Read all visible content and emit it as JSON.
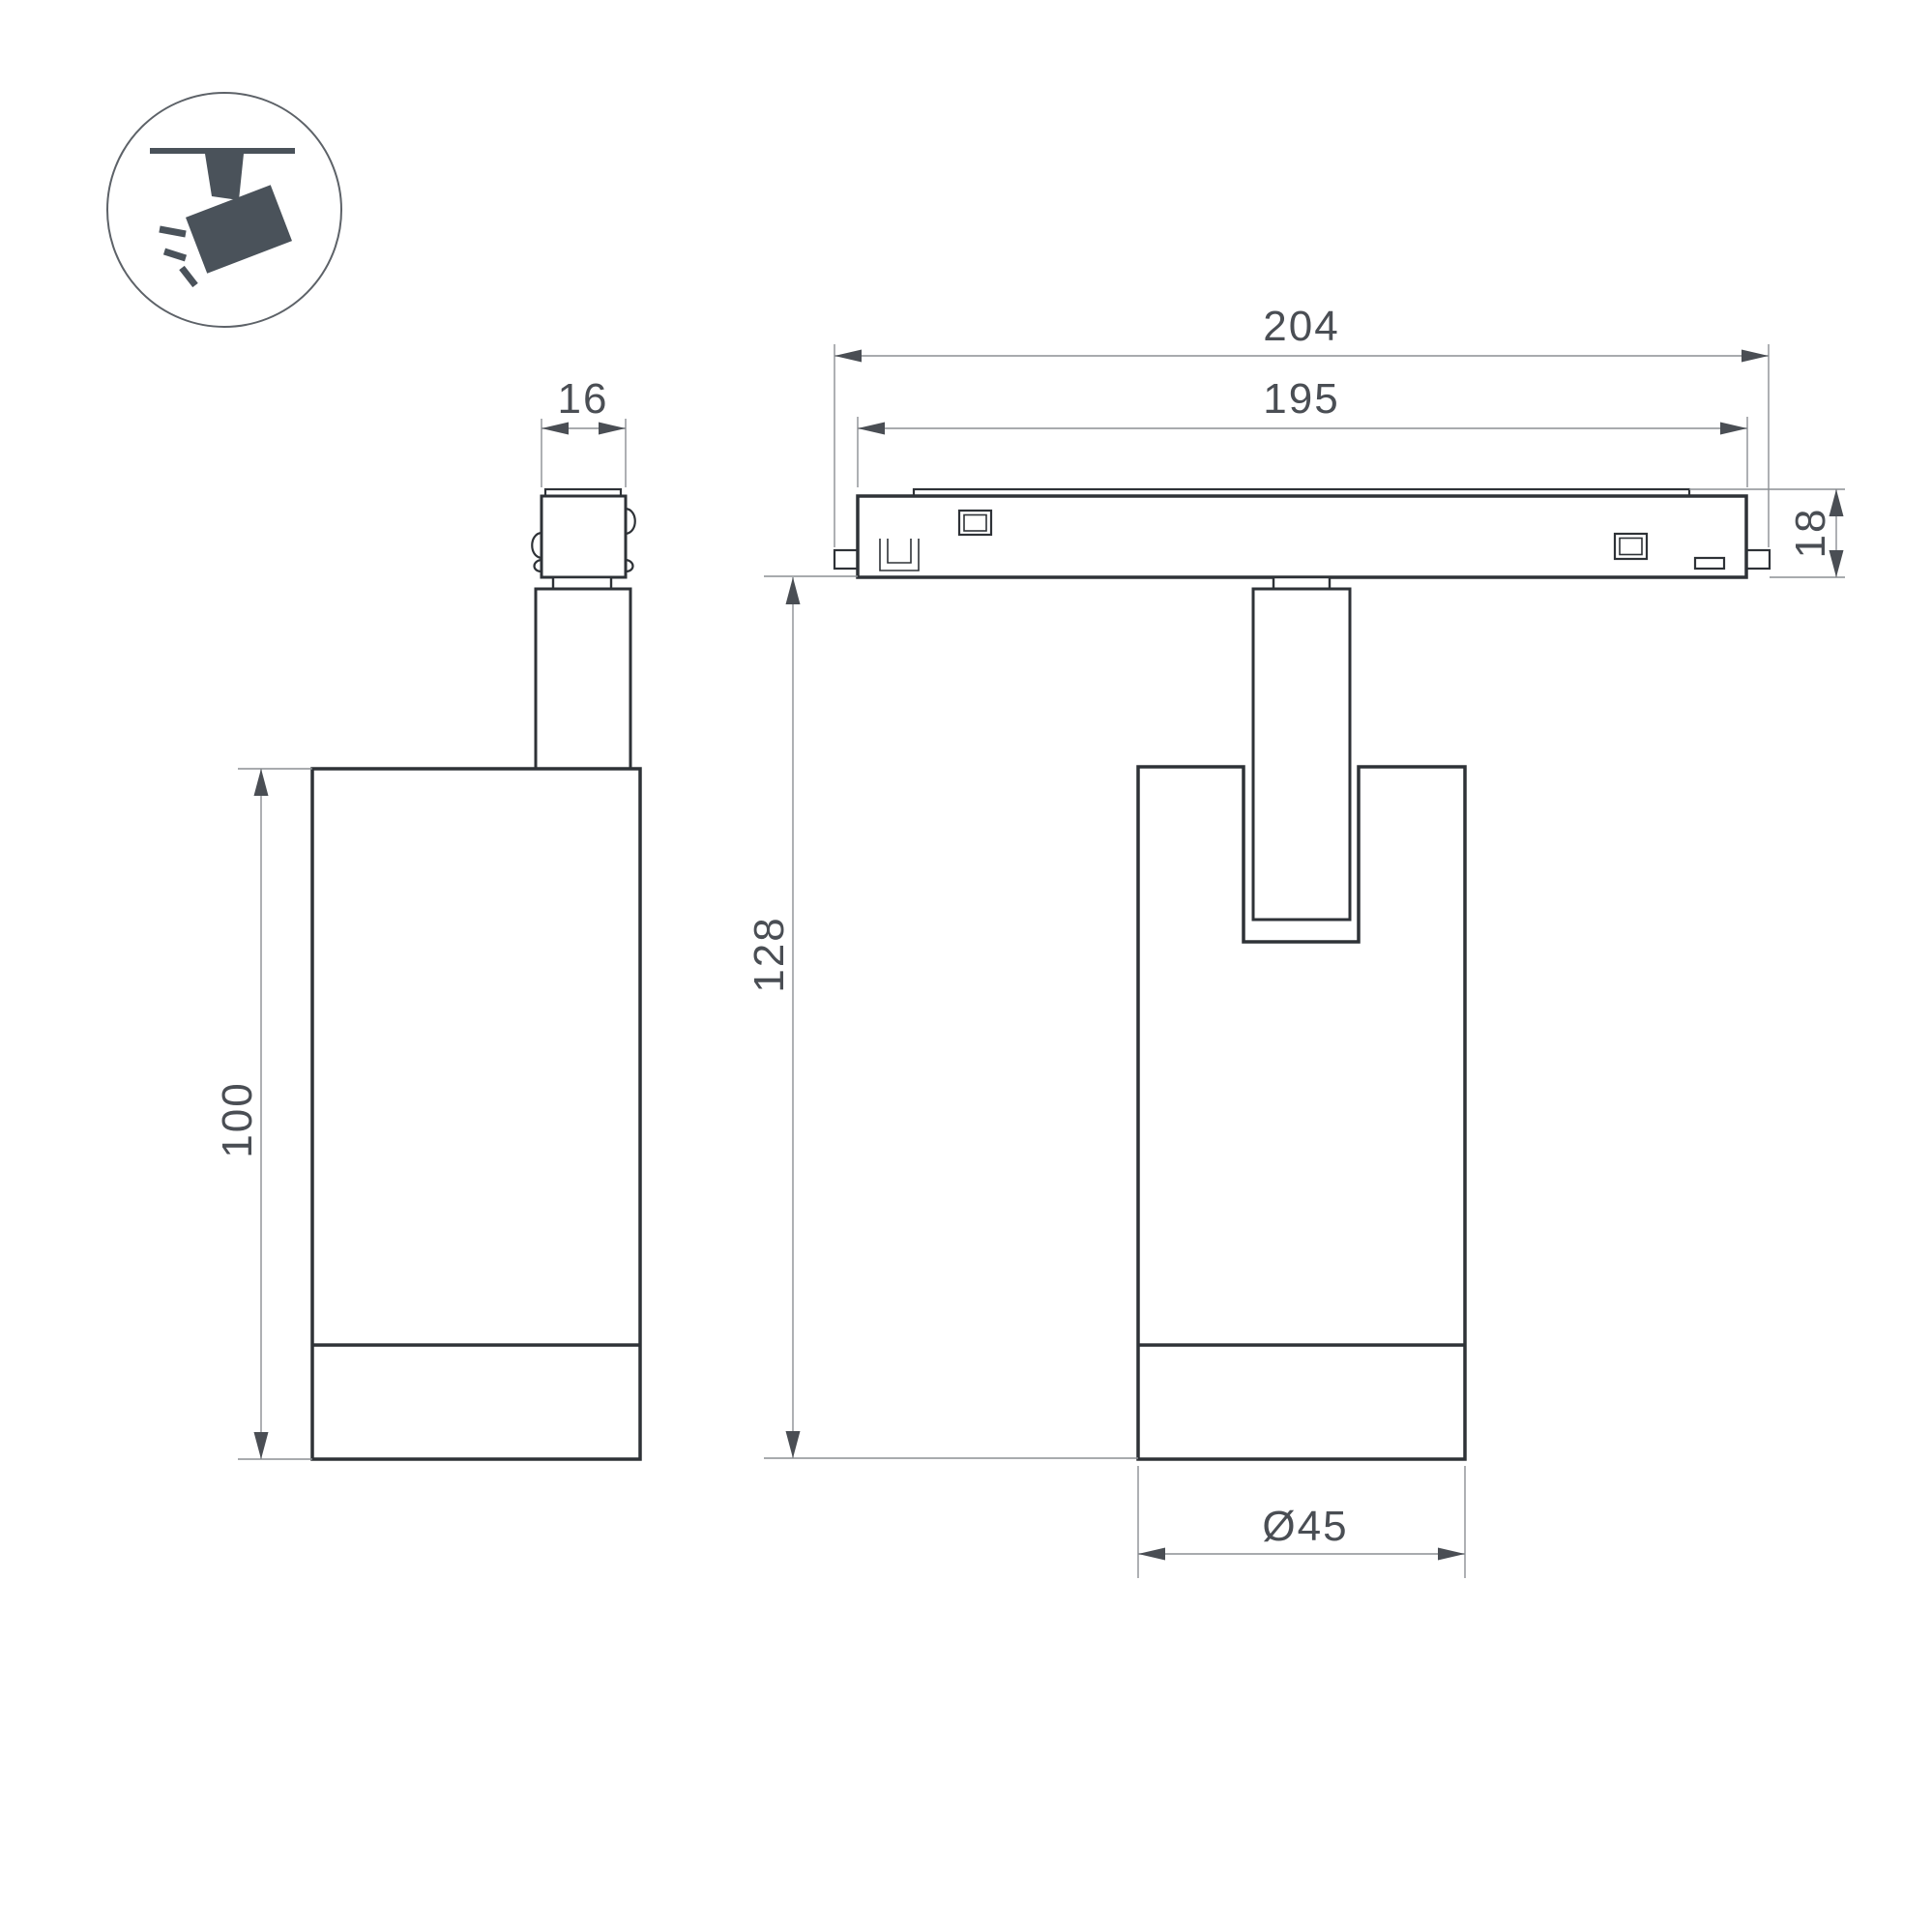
{
  "dimensions": {
    "adapter_width": "16",
    "body_height": "100",
    "track_overall_length": "204",
    "track_body_length": "195",
    "track_height": "18",
    "hang_height": "128",
    "spot_diameter": "Ø45"
  },
  "icon": {
    "name": "ceiling-track-spotlight"
  },
  "colors": {
    "bg": "#ffffff",
    "ink": "#2e3237",
    "dim-line": "#8b8f93",
    "dim-ink": "#4a4e54",
    "icon-ink": "#4a525a"
  }
}
